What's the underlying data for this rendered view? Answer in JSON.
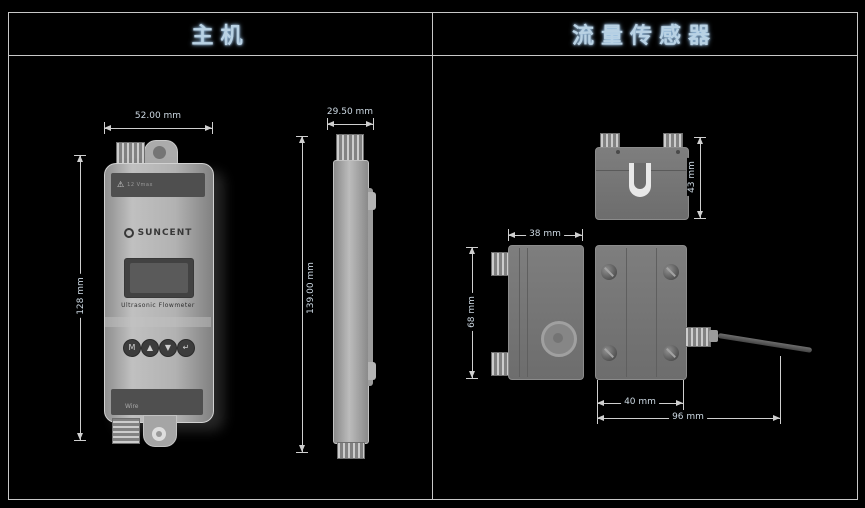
{
  "header": {
    "left_title": "主机",
    "right_title": "流量传感器"
  },
  "main_unit": {
    "front_view": {
      "warning_icon": "⚠",
      "warning_text": "12 Vmax",
      "brand": "SUNCENT",
      "subtitle": "Ultrasonic Flowmeter",
      "buttons": [
        "M",
        "▲",
        "▼",
        "↵"
      ],
      "port_label": "Wire",
      "port_arrow": "▼"
    },
    "dimensions": {
      "width": "52.00 mm",
      "depth": "29.50 mm",
      "body_height": "128 mm",
      "total_height": "139.00 mm"
    }
  },
  "flow_sensor": {
    "dimensions": {
      "top_depth": "43 mm",
      "side_width": "38 mm",
      "side_height": "68 mm",
      "bottom_width": "40 mm",
      "overall_width": "96 mm"
    }
  },
  "colors": {
    "background": "#000000",
    "frame": "#c8c8c8",
    "header_text": "#b9d2e4",
    "dimension_text": "#ccd8e2",
    "device_gray": "#aaaaaa"
  }
}
